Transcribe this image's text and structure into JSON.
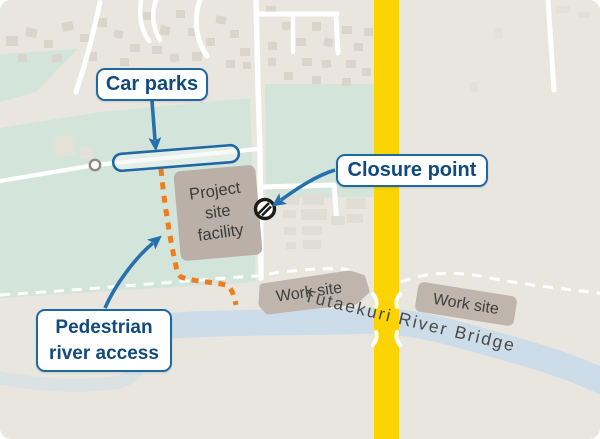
{
  "callouts": {
    "car_parks": {
      "label": "Car parks"
    },
    "closure_point": {
      "label": "Closure point"
    },
    "pedestrian_river_access": {
      "line1": "Pedestrian",
      "line2": "river access"
    }
  },
  "map_text": {
    "facility_line1": "Project",
    "facility_line2": "site",
    "facility_line3": "facility",
    "work_site_left": "Work site",
    "work_site_right": "Work site",
    "bridge": "Tutaekuri River Bridge"
  },
  "icons": {
    "closure_point": "no-entry-icon"
  },
  "colors": {
    "background_beige": "#e9e6df",
    "field_green": "#d3e5da",
    "building_grey": "#d9d5cb",
    "road_white": "#ffffff",
    "highway_yellow": "#fcd303",
    "river_blue": "#ccdde9",
    "site_grey": "#bcb2a9",
    "callout_border_blue": "#1e68a6",
    "callout_text_navy": "#114a7e",
    "arrow_blue": "#2471ae",
    "pedestrian_path_orange": "#ee7d1d",
    "map_text_grey": "#3f3f3d"
  }
}
